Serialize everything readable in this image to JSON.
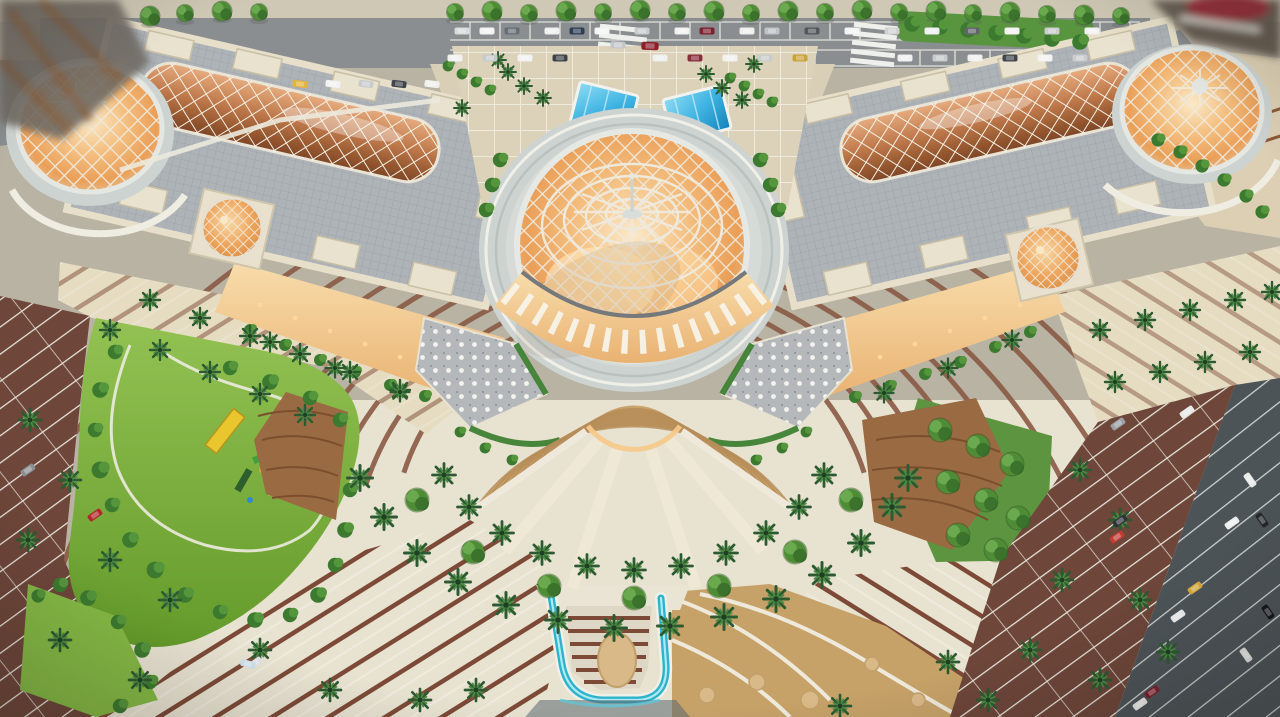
{
  "meta": {
    "scene_type": "aerial-photo-of-architectural-scale-model",
    "subject": "grand domed shopping-mall model with twin barrel-vault wings, fan staircase plaza, palm landscaping and parking lots",
    "width": 1280,
    "height": 717
  },
  "palette": {
    "base": "#b9b3a4",
    "road_gray": "#8a8e90",
    "road_dark": "#4d5458",
    "sidewalk": "#cfc8b4",
    "roof_gray": "#aeb3b8",
    "roof_line": "#9aa0a6",
    "parapet": "#e7dfc9",
    "parapet_line": "#c9bfa3",
    "copper_hi": "#e7ad80",
    "copper_lo": "#7e4526",
    "vault_grid": "#f5f0e4",
    "glow_core": "#fbe9c8",
    "glow_mid": "#f2b878",
    "glow_deep": "#e2a055",
    "dome_rim": "#e4e7e2",
    "lattice": "#efe9db",
    "ring_plaza": "#cdd3d0",
    "drum": "#d7dbd7",
    "plaza_top": "#dcd2ba",
    "plaza_cream": "#e8e2d1",
    "plaza_brown": "#8a5a44",
    "stripe_brown": "#7c4a36",
    "steps_tan": "#cba46c",
    "step_line": "#b68d58",
    "stringer": "#efe8d5",
    "table_gray": "#b5b8ba",
    "hedge": "#3f8134",
    "lawn": "#7eb33b",
    "bush_dark": "#2f6b2d",
    "palm_green": "#2c5a31",
    "parking_brown": "#6e463a",
    "stripe_white": "#e9e7dc",
    "water": "#2fb3cc",
    "water_hi": "#aeeaf4",
    "sky_hi": "#8fdcf4",
    "sky_lo": "#1480b8",
    "gold_paving": "#c6a268",
    "disc_tan": "#d9b987",
    "pergola_wood": "#9a6a42",
    "pergola_line": "#7b4f2e",
    "warm_light": "#f6c98b"
  },
  "scene": {
    "elements": {
      "central-dome": "large white diagrid lattice dome glowing warm orange, apex spire",
      "left-vault": "copper diagrid barrel skylight on left wing roof",
      "right-vault": "copper diagrid barrel skylight on right wing roof",
      "left-end-dome": "glowing lattice dome at far left end",
      "right-end-dome": "glowing lattice dome at far right end",
      "spiral-dome-left": "small rosette skylight dome on left wing facade",
      "spiral-dome-right": "small rosette skylight dome on right wing facade",
      "grand-staircase": "fan of tan steps descending from dome terrace",
      "water-feature": "U-shaped aqua waterfall channel at bottom center",
      "skylights-blue": "two blue glass skylight panels on upper plaza",
      "park": "kidney-shaped lawn with playground equipment",
      "parking": "brown lots with white bays, palms and model cars",
      "road-top": "asphalt street with parked model cars and tree row"
    },
    "stairs": {
      "cx": 634,
      "cy": 398,
      "half_angle": 55,
      "step_radii": [
        74,
        86,
        98,
        110,
        122,
        134,
        146,
        158,
        170,
        182,
        194
      ]
    },
    "plaza": {
      "cx": 634,
      "cy": 398,
      "half_angle": 72,
      "arc_radii": [
        242,
        282,
        322,
        372,
        422,
        478,
        540,
        608,
        678
      ]
    },
    "fountain_discs": [
      [
        707,
        695,
        8
      ],
      [
        757,
        682,
        8
      ],
      [
        810,
        700,
        9
      ],
      [
        872,
        664,
        7
      ],
      [
        918,
        700,
        7
      ]
    ],
    "vegetation": {
      "trees_top": [
        [
          455,
          12
        ],
        [
          492,
          11
        ],
        [
          529,
          13
        ],
        [
          566,
          11
        ],
        [
          603,
          12
        ],
        [
          640,
          10
        ],
        [
          677,
          12
        ],
        [
          714,
          11
        ],
        [
          751,
          13
        ],
        [
          788,
          11
        ],
        [
          825,
          12
        ],
        [
          862,
          10
        ],
        [
          899,
          12
        ],
        [
          936,
          11
        ],
        [
          973,
          13
        ],
        [
          1010,
          12
        ],
        [
          1047,
          14
        ],
        [
          1084,
          15
        ],
        [
          1121,
          16
        ],
        [
          150,
          16
        ],
        [
          185,
          13
        ],
        [
          222,
          11
        ],
        [
          259,
          12
        ]
      ],
      "round_trees": [
        [
          417,
          500
        ],
        [
          473,
          552
        ],
        [
          549,
          586
        ],
        [
          634,
          598
        ],
        [
          719,
          586
        ],
        [
          795,
          552
        ],
        [
          851,
          500
        ],
        [
          940,
          430
        ],
        [
          978,
          446
        ],
        [
          1012,
          464
        ],
        [
          948,
          482
        ],
        [
          986,
          500
        ],
        [
          1018,
          518
        ],
        [
          958,
          535
        ],
        [
          996,
          550
        ]
      ],
      "palms": [
        [
          444,
          475,
          1.15
        ],
        [
          469,
          507,
          1.15
        ],
        [
          502,
          533,
          1.15
        ],
        [
          542,
          553,
          1.15
        ],
        [
          587,
          566,
          1.15
        ],
        [
          634,
          570,
          1.15
        ],
        [
          681,
          566,
          1.15
        ],
        [
          726,
          553,
          1.15
        ],
        [
          766,
          533,
          1.15
        ],
        [
          799,
          507,
          1.15
        ],
        [
          824,
          475,
          1.15
        ],
        [
          360,
          478,
          1.25
        ],
        [
          384,
          517,
          1.25
        ],
        [
          417,
          553,
          1.25
        ],
        [
          458,
          582,
          1.25
        ],
        [
          506,
          605,
          1.25
        ],
        [
          558,
          620,
          1.25
        ],
        [
          614,
          628,
          1.25
        ],
        [
          670,
          626,
          1.25
        ],
        [
          724,
          617,
          1.25
        ],
        [
          776,
          599,
          1.25
        ],
        [
          822,
          575,
          1.25
        ],
        [
          861,
          543,
          1.25
        ],
        [
          892,
          507,
          1.25
        ],
        [
          908,
          478,
          1.25
        ],
        [
          150,
          300,
          1
        ],
        [
          200,
          318,
          1
        ],
        [
          250,
          336,
          1
        ],
        [
          300,
          354,
          1
        ],
        [
          350,
          372,
          1
        ],
        [
          400,
          390,
          1
        ],
        [
          110,
          330,
          1
        ],
        [
          160,
          350,
          1
        ],
        [
          210,
          372,
          1
        ],
        [
          260,
          394,
          1
        ],
        [
          305,
          415,
          1
        ],
        [
          1100,
          330,
          1
        ],
        [
          1145,
          320,
          1
        ],
        [
          1190,
          310,
          1
        ],
        [
          1235,
          300,
          1
        ],
        [
          1272,
          292,
          1
        ],
        [
          1115,
          382,
          1
        ],
        [
          1160,
          372,
          1
        ],
        [
          1205,
          362,
          1
        ],
        [
          1250,
          352,
          1
        ],
        [
          270,
          342,
          0.95
        ],
        [
          335,
          368,
          0.95
        ],
        [
          400,
          392,
          0.95
        ],
        [
          1012,
          340,
          0.95
        ],
        [
          948,
          368,
          0.95
        ],
        [
          884,
          393,
          0.95
        ],
        [
          30,
          420,
          1.1
        ],
        [
          70,
          480,
          1.1
        ],
        [
          28,
          540,
          1.1
        ],
        [
          110,
          560,
          1.1
        ],
        [
          170,
          600,
          1.1
        ],
        [
          60,
          640,
          1.1
        ],
        [
          140,
          680,
          1.1
        ],
        [
          260,
          650,
          1.1
        ],
        [
          330,
          690,
          1.1
        ],
        [
          420,
          700,
          1.1
        ],
        [
          1080,
          470,
          1.1
        ],
        [
          1120,
          520,
          1.1
        ],
        [
          1062,
          580,
          1.1
        ],
        [
          1140,
          600,
          1.1
        ],
        [
          1030,
          650,
          1.1
        ],
        [
          1100,
          680,
          1.1
        ],
        [
          988,
          700,
          1.1
        ],
        [
          1168,
          652,
          1.1
        ],
        [
          476,
          690,
          1.1
        ],
        [
          840,
          706,
          1.1
        ],
        [
          948,
          662,
          1.1
        ],
        [
          508,
          72,
          0.8
        ],
        [
          524,
          86,
          0.8
        ],
        [
          543,
          98,
          0.8
        ],
        [
          498,
          60,
          0.8
        ],
        [
          706,
          74,
          0.8
        ],
        [
          722,
          88,
          0.8
        ],
        [
          742,
          100,
          0.8
        ],
        [
          754,
          64,
          0.8
        ],
        [
          462,
          108,
          0.8
        ]
      ],
      "bushes": [
        [
          115,
          352,
          1.2
        ],
        [
          100,
          390,
          1.3
        ],
        [
          95,
          430,
          1.2
        ],
        [
          100,
          470,
          1.4
        ],
        [
          112,
          505,
          1.2
        ],
        [
          130,
          540,
          1.3
        ],
        [
          155,
          570,
          1.4
        ],
        [
          185,
          595,
          1.3
        ],
        [
          220,
          612,
          1.2
        ],
        [
          255,
          620,
          1.3
        ],
        [
          290,
          615,
          1.2
        ],
        [
          318,
          595,
          1.3
        ],
        [
          335,
          565,
          1.2
        ],
        [
          345,
          530,
          1.3
        ],
        [
          350,
          490,
          1.2
        ],
        [
          230,
          368,
          1.2
        ],
        [
          270,
          382,
          1.3
        ],
        [
          310,
          398,
          1.2
        ],
        [
          340,
          420,
          1.2
        ],
        [
          38,
          596,
          1.1
        ],
        [
          60,
          585,
          1.2
        ],
        [
          88,
          598,
          1.3
        ],
        [
          118,
          622,
          1.2
        ],
        [
          142,
          650,
          1.3
        ],
        [
          150,
          682,
          1.2
        ],
        [
          120,
          706,
          1.2
        ],
        [
          250,
          330,
          1
        ],
        [
          285,
          345,
          1
        ],
        [
          320,
          360,
          1
        ],
        [
          355,
          372,
          1
        ],
        [
          390,
          385,
          1
        ],
        [
          425,
          396,
          1
        ],
        [
          1030,
          332,
          1
        ],
        [
          995,
          347,
          1
        ],
        [
          960,
          362,
          1
        ],
        [
          925,
          374,
          1
        ],
        [
          890,
          386,
          1
        ],
        [
          855,
          397,
          1
        ],
        [
          448,
          66,
          0.9
        ],
        [
          462,
          74,
          0.9
        ],
        [
          476,
          82,
          0.9
        ],
        [
          490,
          90,
          0.9
        ],
        [
          730,
          78,
          0.9
        ],
        [
          744,
          86,
          0.9
        ],
        [
          758,
          94,
          0.9
        ],
        [
          772,
          102,
          0.9
        ],
        [
          760,
          160,
          1.2
        ],
        [
          770,
          185,
          1.2
        ],
        [
          778,
          210,
          1.2
        ],
        [
          500,
          160,
          1.2
        ],
        [
          492,
          185,
          1.2
        ],
        [
          486,
          210,
          1.2
        ],
        [
          460,
          432,
          0.9
        ],
        [
          485,
          448,
          0.9
        ],
        [
          512,
          460,
          0.9
        ],
        [
          806,
          432,
          0.9
        ],
        [
          782,
          448,
          0.9
        ],
        [
          756,
          460,
          0.9
        ],
        [
          1158,
          140,
          1.1
        ],
        [
          1180,
          152,
          1.1
        ],
        [
          1202,
          166,
          1.1
        ],
        [
          1224,
          180,
          1.1
        ],
        [
          1246,
          196,
          1.1
        ],
        [
          1262,
          212,
          1.1
        ],
        [
          912,
          24,
          1.3
        ],
        [
          940,
          27,
          1.3
        ],
        [
          968,
          30,
          1.3
        ],
        [
          996,
          33,
          1.3
        ],
        [
          1024,
          36,
          1.3
        ],
        [
          1052,
          39,
          1.3
        ],
        [
          1080,
          42,
          1.3
        ]
      ]
    },
    "vehicles": {
      "cars": [
        [
          462,
          31,
          0,
          "#d9dbdb"
        ],
        [
          487,
          31,
          0,
          "#f2f3f2"
        ],
        [
          512,
          31,
          0,
          "#667077"
        ],
        [
          552,
          31,
          0,
          "#eef0f0"
        ],
        [
          577,
          31,
          0,
          "#2e3f55"
        ],
        [
          602,
          31,
          0,
          "#f5f5f4"
        ],
        [
          642,
          31,
          0,
          "#c9cccd"
        ],
        [
          682,
          31,
          0,
          "#f2f2f1"
        ],
        [
          707,
          31,
          0,
          "#7a2230"
        ],
        [
          747,
          31,
          0,
          "#eef0ef"
        ],
        [
          772,
          31,
          0,
          "#bfc3c6"
        ],
        [
          812,
          31,
          0,
          "#54585c"
        ],
        [
          852,
          31,
          0,
          "#f3f4f3"
        ],
        [
          892,
          31,
          0,
          "#d0d2d2"
        ],
        [
          932,
          31,
          0,
          "#eef0ef"
        ],
        [
          972,
          31,
          0,
          "#60656a"
        ],
        [
          1012,
          31,
          0,
          "#f2f3f2"
        ],
        [
          1052,
          31,
          0,
          "#caccce"
        ],
        [
          1092,
          31,
          0,
          "#f1f2f1"
        ],
        [
          455,
          58,
          0,
          "#f0f1f0"
        ],
        [
          490,
          58,
          0,
          "#c8cbcb"
        ],
        [
          525,
          58,
          0,
          "#f2f2f1"
        ],
        [
          560,
          58,
          0,
          "#3e434a"
        ],
        [
          660,
          58,
          0,
          "#eef0ef"
        ],
        [
          695,
          58,
          0,
          "#8a2d3a"
        ],
        [
          730,
          58,
          0,
          "#f1f1f0"
        ],
        [
          765,
          58,
          0,
          "#c9cccc"
        ],
        [
          800,
          58,
          0,
          "#caa23b"
        ],
        [
          905,
          58,
          0,
          "#f0f1f0"
        ],
        [
          940,
          58,
          0,
          "#c8cbcb"
        ],
        [
          975,
          58,
          0,
          "#eff0ef"
        ],
        [
          1010,
          58,
          0,
          "#41464c"
        ],
        [
          1045,
          58,
          0,
          "#f1f2f1"
        ],
        [
          1080,
          58,
          0,
          "#c9cccc"
        ],
        [
          300,
          84,
          7,
          "#e3b33c"
        ],
        [
          333,
          84,
          7,
          "#f1f2f1"
        ],
        [
          366,
          84,
          7,
          "#c9cccc"
        ],
        [
          399,
          84,
          7,
          "#41464c"
        ],
        [
          432,
          84,
          7,
          "#eff0ef"
        ],
        [
          618,
          45,
          2,
          "#c4c7c9"
        ],
        [
          650,
          46,
          2,
          "#8e1f2a",
          1.15
        ],
        [
          95,
          515,
          -35,
          "#b02828"
        ],
        [
          255,
          663,
          -35,
          "#dfe3e6"
        ],
        [
          28,
          470,
          -35,
          "#8a8f93"
        ],
        [
          248,
          664,
          15,
          "#cfe0ea"
        ],
        [
          1187,
          412,
          -35,
          "#e8eaea"
        ],
        [
          1118,
          424,
          -35,
          "#9aa0a3"
        ],
        [
          1120,
          521,
          -35,
          "#2e3338"
        ],
        [
          1117,
          537,
          -35,
          "#c23a34"
        ],
        [
          1232,
          523,
          -35,
          "#eceeee"
        ],
        [
          1250,
          480,
          55,
          "#e9ebe9"
        ],
        [
          1262,
          520,
          55,
          "#23272b"
        ],
        [
          1195,
          588,
          -35,
          "#d9a93c"
        ],
        [
          1178,
          616,
          -35,
          "#eceff0"
        ],
        [
          1152,
          692,
          -35,
          "#7e1f2c"
        ],
        [
          1140,
          704,
          -35,
          "#e8e8e6"
        ],
        [
          1268,
          612,
          55,
          "#16181b"
        ],
        [
          1246,
          655,
          55,
          "#dddfdd"
        ]
      ]
    }
  }
}
